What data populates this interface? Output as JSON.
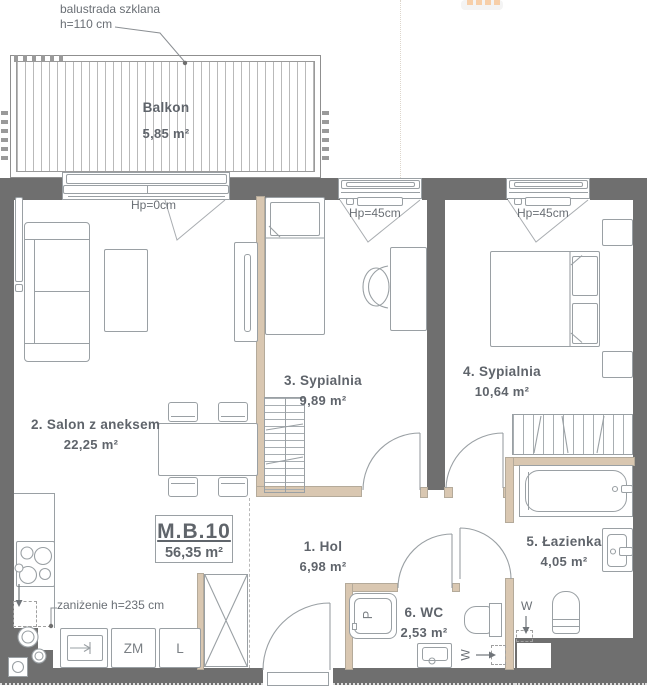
{
  "unit": {
    "id": "M.B.10",
    "area": "56,35 m²"
  },
  "rooms": {
    "balkon": {
      "name": "Balkon",
      "area": "5,85 m²"
    },
    "salon": {
      "name": "2. Salon z aneksem",
      "area": "22,25 m²"
    },
    "sypialnia3": {
      "name": "3. Sypialnia",
      "area": "9,89 m²"
    },
    "sypialnia4": {
      "name": "4. Sypialnia",
      "area": "10,64 m²"
    },
    "hol": {
      "name": "1. Hol",
      "area": "6,98 m²"
    },
    "lazienka": {
      "name": "5. Łazienka",
      "area": "4,05 m²"
    },
    "wc": {
      "name": "6. WC",
      "area": "2,53 m²"
    }
  },
  "annotations": {
    "balustrade_line1": "balustrada szklana",
    "balustrade_line2": "h=110 cm",
    "sill_salon": "Hp=0cm",
    "sill_sypialnia3": "Hp=45cm",
    "sill_sypialnia4": "Hp=45cm",
    "lowered_ceiling": "zaniżenie h=235 cm",
    "appliance_dishwasher": "ZM",
    "appliance_fridge": "L",
    "appliance_washer": "P",
    "vent_wc": "W",
    "vent_bathroom": "W"
  },
  "colors": {
    "wall": "#6f6f6f",
    "partition": "#d9c7b1",
    "outline": "#9aa0a4",
    "text": "#5f646b",
    "accent_squares": "#f7cfa9"
  }
}
